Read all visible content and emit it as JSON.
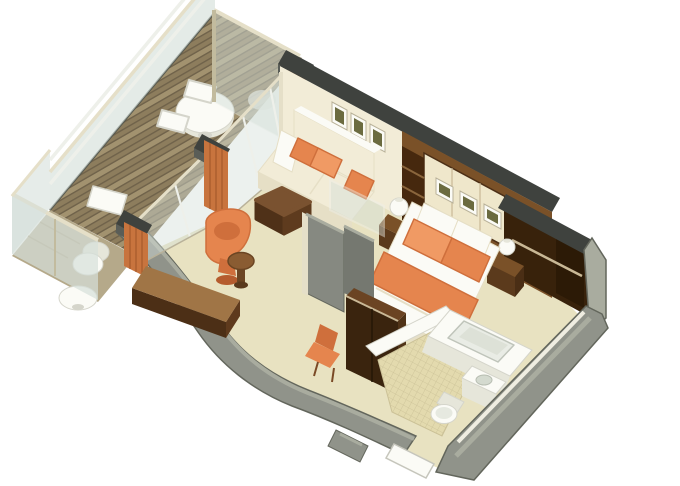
{
  "scene": {
    "title": "3D isometric cutaway rendering of a suite floor plan with private balcony",
    "view": "axonometric cutaway, walls cut at waist height, white background",
    "rooms": [
      {
        "id": "balcony",
        "label": "Balcony",
        "furniture": [
          "wood plank decking",
          "round dining table",
          "two dining chairs",
          "deck bench panel",
          "glass railing with three rails",
          "frosted privacy divider",
          "neighbor balcony chair",
          "neighbor balcony oval table"
        ]
      },
      {
        "id": "living-area",
        "label": "Living Area",
        "furniture": [
          "cream sofa with chaise",
          "three orange throw pillows",
          "square brown ottoman coffee table",
          "orange swivel tub chair",
          "round wood side table",
          "writing desk along curved wall",
          "orange desk chair",
          "three framed pictures",
          "floor-to-ceiling sliding glass doors",
          "three orange curtain panels"
        ]
      },
      {
        "id": "bedroom",
        "label": "Bedroom",
        "furniture": [
          "double bed with white duvet",
          "orange bed runner",
          "two orange pillows",
          "two white pillows",
          "wood headboard wall with three framed prints",
          "open shelf column",
          "two dark wood nightstands",
          "two white sphere table lamps",
          "glass-topped partition wall",
          "tall dark wood TV cabinet"
        ]
      },
      {
        "id": "bathroom",
        "label": "Bathroom",
        "furniture": [
          "bathtub",
          "vanity with sink",
          "toilet",
          "mosaic tile floor"
        ]
      },
      {
        "id": "closet",
        "label": "Walk-in Closet",
        "furniture": [
          "hanging rod",
          "dark wood interior"
        ]
      },
      {
        "id": "entry",
        "label": "Entry",
        "furniture": [
          "white entry door",
          "curved gray outer wall"
        ]
      }
    ]
  },
  "colors": {
    "bg": "#ffffff",
    "carpet": "#e8e2c1",
    "carpetShade": "#ddd6b2",
    "tile": "#e3daae",
    "tileLine": "#cbc197",
    "deck": "#8d7d5d",
    "deckDark": "#6f624a",
    "deckLight": "#a2926f",
    "deckNeighbor": "#b5a98a",
    "wallGray": "#90938a",
    "wallGrayLight": "#a9ac9f",
    "wallGrayDark": "#63665c",
    "panelGray": "#868981",
    "panelGrayDark": "#757870",
    "capDark": "#3f423e",
    "capSide": "#5a5d57",
    "cream": "#f2ecd7",
    "creamShade": "#e6dfc6",
    "creamPanel": "#efe7cb",
    "white": "#fbfbf6",
    "whiteShade": "#e6e6da",
    "whiteLine": "#d5d5cb",
    "glass": "#d5e0da",
    "glassBright": "#eef0ea",
    "railTan": "#e5dfc8",
    "framePost": "#c2bb9e",
    "orange": "#e5854e",
    "orangeDeep": "#cf6f3c",
    "orangeLight": "#f09a64",
    "orangeCurtain": "#c8743e",
    "orangeCurtainDark": "#a55a2c",
    "woodMid": "#7a5128",
    "woodDesk": "#a07546",
    "woodDark": "#4c2f16",
    "woodDeep": "#3a240e",
    "woodTrim": "#c9b896",
    "closetDark": "#38220b",
    "artOlive": "#6b6b40",
    "ottoTop": "#7a5230",
    "ottoSide": "#4f3118"
  }
}
